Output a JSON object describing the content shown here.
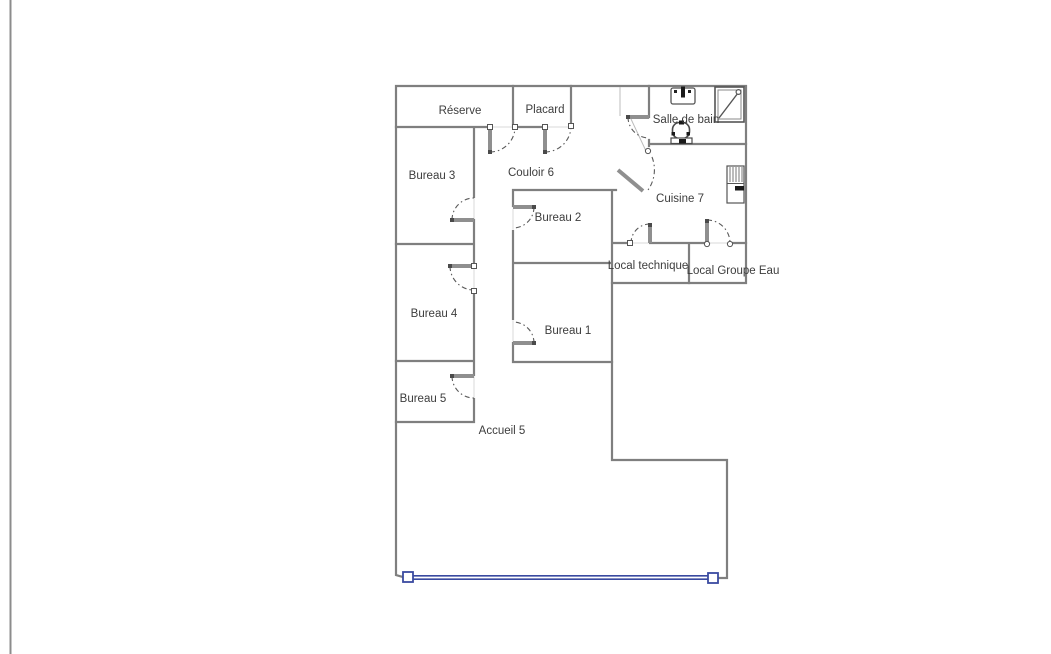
{
  "floor_plan": {
    "rooms": [
      {
        "name": "reserve",
        "label": "Réserve"
      },
      {
        "name": "placard",
        "label": "Placard"
      },
      {
        "name": "salle-de-bain",
        "label": "Salle de bain"
      },
      {
        "name": "bureau-3",
        "label": "Bureau 3"
      },
      {
        "name": "couloir-6",
        "label": "Couloir 6"
      },
      {
        "name": "cuisine-7",
        "label": "Cuisine 7"
      },
      {
        "name": "bureau-2",
        "label": "Bureau 2"
      },
      {
        "name": "local-technique",
        "label": "Local technique"
      },
      {
        "name": "local-groupe-eau",
        "label": "Local Groupe Eau"
      },
      {
        "name": "bureau-4",
        "label": "Bureau 4"
      },
      {
        "name": "bureau-1",
        "label": "Bureau 1"
      },
      {
        "name": "bureau-5",
        "label": "Bureau 5"
      },
      {
        "name": "accueil-5",
        "label": "Accueil 5"
      }
    ],
    "fixtures": [
      {
        "name": "sink-icon"
      },
      {
        "name": "shower-icon"
      },
      {
        "name": "toilet-icon"
      },
      {
        "name": "water-heater-icon"
      }
    ],
    "colors": {
      "wall": "#7f7f7f",
      "door_leaf": "#8f8f8f",
      "door_arc": "#5a5a5a",
      "glazing": "#3a4aa0",
      "label": "#3d3d3d",
      "page_edge": "#8c8c8c"
    }
  }
}
